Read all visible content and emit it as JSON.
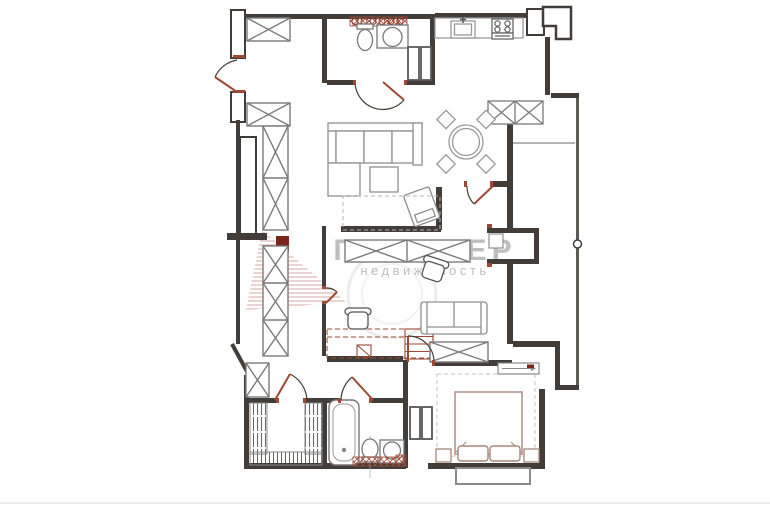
{
  "watermark": {
    "brand": "ПРЕМЬЕР",
    "subtitle": "недвижимость",
    "logo": "red-hatched-fan-building-logo"
  },
  "colors": {
    "background": "#ffffff",
    "walls": "#423d39",
    "furniture_outline": "#8f8f8f",
    "bedroom_furniture": "#a5897a",
    "accent_red": "#9c4a35",
    "accent_dark_red": "#7a241a",
    "watermark_gray": "#8a8a8a"
  },
  "plan": {
    "type": "apartment-floor-plan",
    "fixtures": [
      "entry-door",
      "hall-wardrobes",
      "toilet",
      "washbasin",
      "vanity-counter",
      "kitchen-sink",
      "stove",
      "corner-sofa",
      "coffee-table",
      "armchair",
      "round-dining-table",
      "dining-chairs",
      "balcony",
      "balcony-door",
      "study-desk",
      "office-chairs",
      "study-sofa",
      "x-wardrobes",
      "walk-in-closet-rails",
      "bathtub",
      "washing-unit",
      "double-bed",
      "pillows",
      "nightstands",
      "bay-window"
    ]
  }
}
